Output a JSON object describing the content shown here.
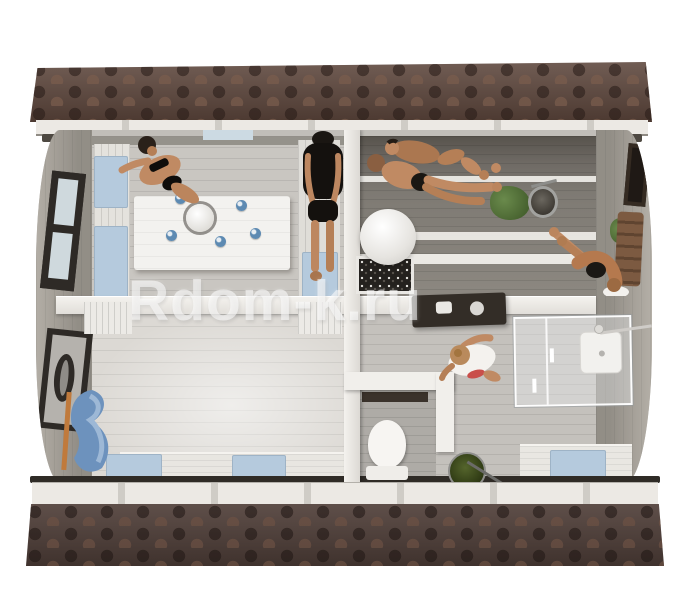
{
  "watermark": {
    "text": "Rdom-k.ru",
    "color": "#ffffff"
  },
  "scene": {
    "description": "top-down-3d-cutaway-render-of-barrel-style-sauna-house",
    "people_count": 6,
    "rooms": [
      {
        "name": "lounge-room",
        "objects": [
          "white-dining-table",
          "five-blue-cups",
          "white-teapot",
          "left-bench-with-blue-cushions",
          "right-bench-with-blue-cushion",
          "woman-in-black-bikini",
          "man-in-black-swimsuit",
          "left-wall-window",
          "top-wall-window"
        ]
      },
      {
        "name": "sauna-room",
        "objects": [
          "tiered-benches",
          "sauna-heater-with-stones",
          "white-sphere-lamp",
          "metal-water-bucket",
          "green-plant",
          "two-men-lying-on-bench",
          "person-bending-on-bench",
          "wooden-backrest",
          "right-wall-window"
        ]
      },
      {
        "name": "changing-room",
        "objects": [
          "entrance-door-with-oval-window",
          "blue-bathrobe-hanging",
          "bottom-bench-with-two-blue-cushions",
          "white-slat-benches"
        ]
      },
      {
        "name": "washroom",
        "objects": [
          "dark-wall-mounted-vanity",
          "woman-wrapped-in-white-towel",
          "green-bucket-with-ladle"
        ]
      },
      {
        "name": "toilet-room",
        "objects": [
          "white-toilet"
        ]
      },
      {
        "name": "shower-area",
        "objects": [
          "glass-shower-cabin",
          "white-shower-tray",
          "shower-head-arm",
          "bench-with-blue-cushion"
        ]
      }
    ],
    "exterior": [
      "brown-hexagonal-shingle-roof-top",
      "brown-hexagonal-shingle-roof-bottom",
      "white-fascia-with-rafters",
      "curved-grey-side-walls"
    ]
  },
  "palette": {
    "roof_brown": "#5d463c",
    "roof_brown_dark": "#46352e",
    "wall_grey": "#bdbab5",
    "floor_grey": "#c8c5c0",
    "floor_light": "#dcd9d4",
    "wall_white": "#efede9",
    "cushion_blue": "#b5cadd",
    "cup_blue": "#4f80ad",
    "bathrobe_blue": "#6d92bd",
    "skin_tone": "#c08a63",
    "swimsuit_black": "#16130f",
    "plant_green": "#55703c",
    "bucket_green": "#2e3a16",
    "frame_dark": "#2c2825",
    "watermark_white": "#ffffff"
  }
}
